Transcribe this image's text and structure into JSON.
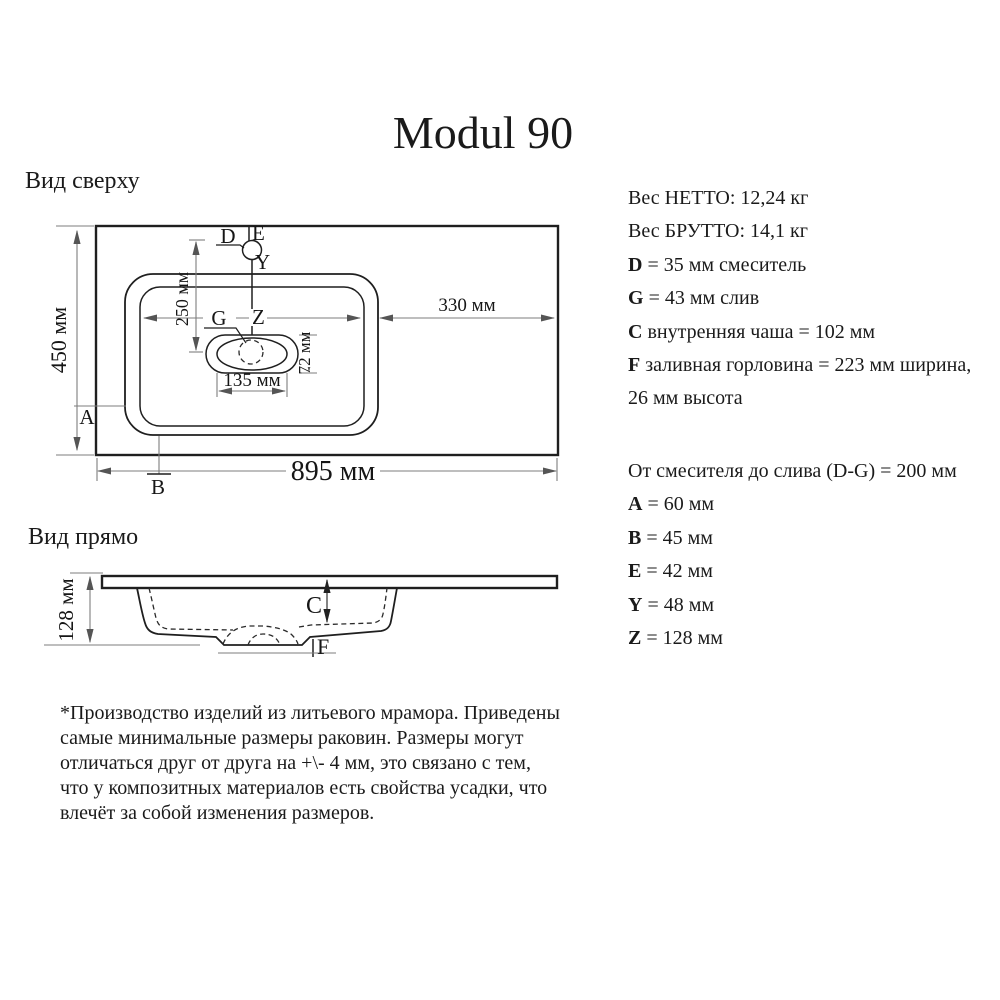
{
  "title": "Modul 90",
  "top_view": {
    "heading": "Вид сверху",
    "dim_width": "895 мм",
    "dim_height": "450 мм",
    "dim_right": "330 мм",
    "dim_faucet": "250 мм",
    "dim_drain_w": "135 мм",
    "dim_drain_h": "72 мм",
    "label_d": "D",
    "label_e": "E",
    "label_y": "Y",
    "label_g": "G",
    "label_z": "Z",
    "label_a": "A",
    "label_b": "B"
  },
  "front_view": {
    "heading": "Вид прямо",
    "dim_height": "128 мм",
    "label_c": "C",
    "label_f": "F"
  },
  "specs": {
    "block1": [
      {
        "b": "",
        "rest": "Вес НЕТТО: 12,24 кг"
      },
      {
        "b": "",
        "rest": "Вес БРУТТО: 14,1 кг"
      },
      {
        "b": "D",
        "rest": " = 35 мм смеситель"
      },
      {
        "b": "G",
        "rest": " = 43 мм слив"
      },
      {
        "b": "C",
        "rest": " внутренняя чаша = 102 мм"
      },
      {
        "b": "F",
        "rest": " заливная горловина = 223 мм ширина,"
      },
      {
        "b": "",
        "rest": "26 мм высота"
      }
    ],
    "block2": [
      {
        "b": "",
        "rest": "От смесителя до слива (D-G) = 200 мм"
      },
      {
        "b": "A",
        "rest": " = 60 мм"
      },
      {
        "b": "B",
        "rest": " = 45 мм"
      },
      {
        "b": "E",
        "rest": " = 42 мм"
      },
      {
        "b": "Y",
        "rest": " = 48 мм"
      },
      {
        "b": "Z",
        "rest": " = 128 мм"
      }
    ]
  },
  "note": {
    "lines": [
      "*Производство изделий из литьевого мрамора. Приведены",
      "самые минимальные размеры раковин. Размеры могут",
      "отличаться друг от друга на +\\- 4 мм, это связано с тем,",
      "что у композитных материалов есть свойства усадки, что",
      "влечёт за собой изменения размеров."
    ]
  }
}
